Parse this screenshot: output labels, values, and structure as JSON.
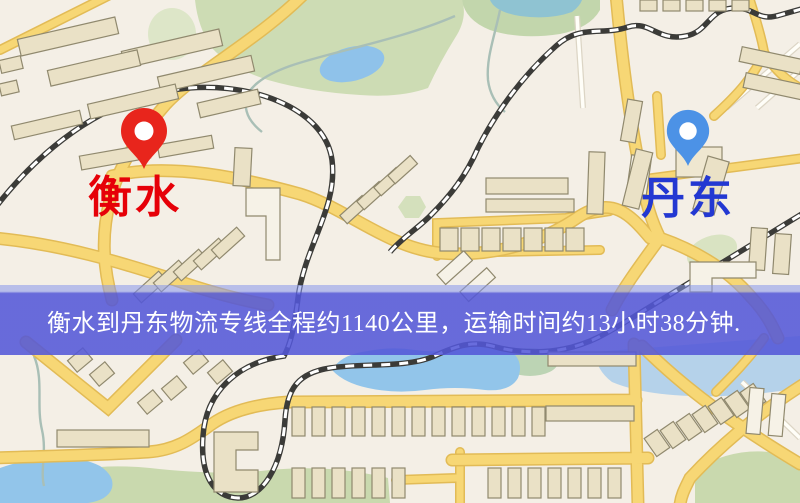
{
  "banner": {
    "text": "衡水到丹东物流专线全程约1140公里，运输时间约13小时38分钟.",
    "bg_color": "#5357d8",
    "text_color": "#ffffff"
  },
  "route": {
    "origin": "衡水",
    "destination": "丹东",
    "distance_text": "全程约1140公里",
    "duration_text": "运输时间约13小时38分钟"
  },
  "markers": {
    "origin": {
      "label": "衡水",
      "icon": "map-pin",
      "label_color": "#e60008",
      "pin_color": "#e8251c"
    },
    "destination": {
      "label": "丹东",
      "icon": "map-pin",
      "label_color": "#2338d2",
      "pin_color": "#4c92e6"
    }
  },
  "map_style": {
    "background": "#f4efe6",
    "road_major": "#f7d775",
    "road_major_casing": "#e2bb56",
    "road_minor": "#fffef8",
    "park_green": "#cddcb4",
    "water_blue": "#92c5ea",
    "building_fill": "#eae1c6",
    "building_stroke": "#90896e",
    "railway": "#3b3b38"
  }
}
